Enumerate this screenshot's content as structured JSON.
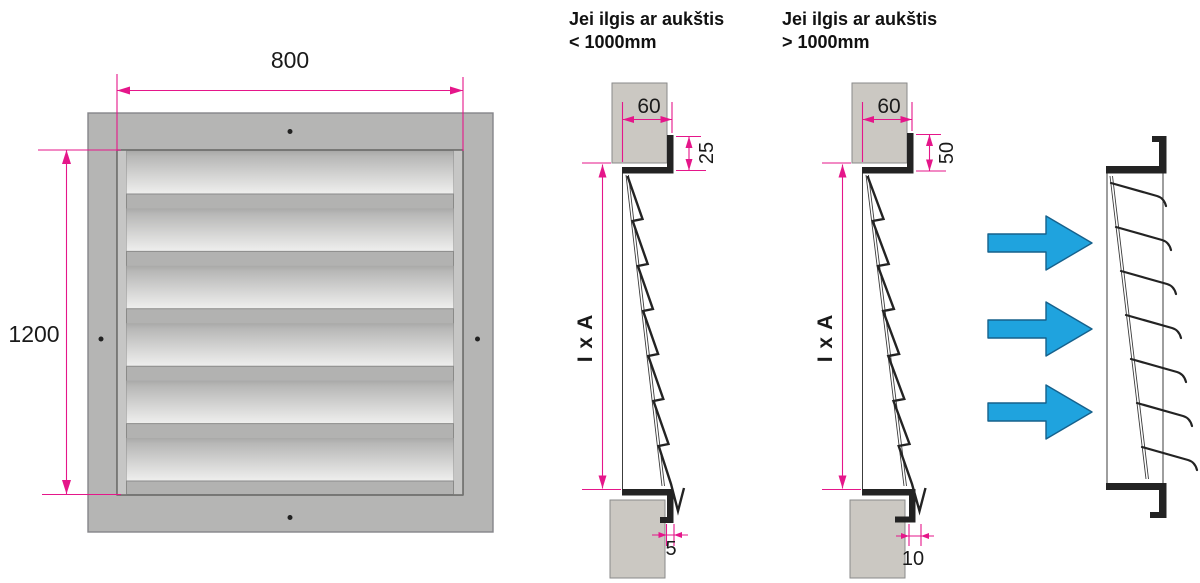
{
  "colors": {
    "dimension": "#e5168a",
    "flow": "#1fa3de",
    "flow_stroke": "#16618c",
    "wall": "#cbc8c2",
    "frame": "#b5b5b4",
    "ink": "#232323"
  },
  "conditions": {
    "small": {
      "title": "Jei ilgis ar aukštis\n< 1000mm"
    },
    "large": {
      "title": "Jei ilgis ar aukštis\n> 1000mm"
    }
  },
  "front_view": {
    "width": "800",
    "height": "1200"
  },
  "section_small": {
    "frame_depth": "60",
    "flange_height": "25",
    "span": "I x A",
    "bottom_gap": "5"
  },
  "section_large": {
    "frame_depth": "60",
    "flange_height": "50",
    "span": "I x A",
    "bottom_gap": "10"
  }
}
